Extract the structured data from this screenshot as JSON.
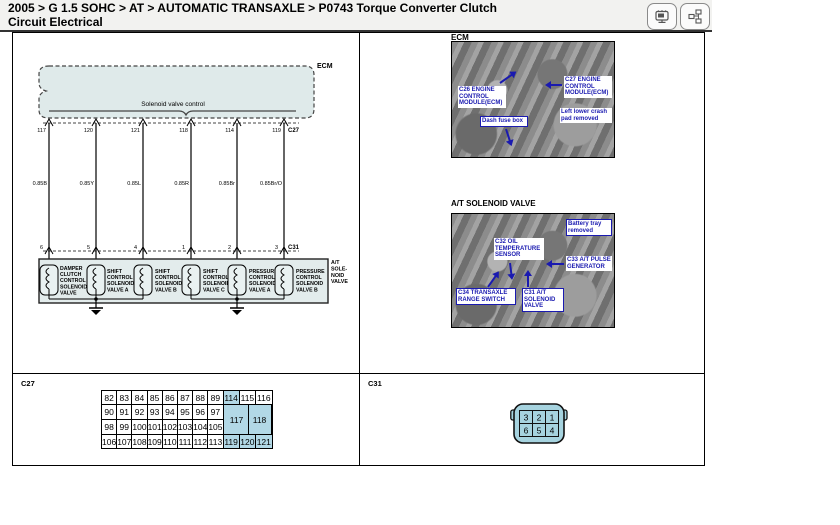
{
  "colors": {
    "callout_blue": "#1a1ab0",
    "highlight_blue": "#b2d8e6",
    "ecm_fill": "#dfeaea",
    "connector_fill": "#a6d3df"
  },
  "header": {
    "title_line1": "2005 > G 1.5 SOHC > AT > AUTOMATIC TRANSAXLE > P0743 Torque Converter Clutch",
    "title_line2": "Circuit Electrical",
    "icons": [
      "window-icon",
      "flowchart-icon"
    ]
  },
  "diagram": {
    "ecm_label": "ECM",
    "bracket_label": "Solenoid valve control",
    "top_connector": "C27",
    "bottom_connector": "C31",
    "wires": [
      {
        "top_pin": "117",
        "wire": "0.85B",
        "bottom_pin": "6"
      },
      {
        "top_pin": "120",
        "wire": "0.85Y",
        "bottom_pin": "5"
      },
      {
        "top_pin": "121",
        "wire": "0.85L",
        "bottom_pin": "4"
      },
      {
        "top_pin": "118",
        "wire": "0.85R",
        "bottom_pin": "1"
      },
      {
        "top_pin": "114",
        "wire": "0.85Br",
        "bottom_pin": "2"
      },
      {
        "top_pin": "119",
        "wire": "0.85Br/O",
        "bottom_pin": "3"
      }
    ],
    "solenoid_box_label": [
      "A/T",
      "SOLE-",
      "NOID",
      "VALVE"
    ],
    "solenoids": [
      [
        "DAMPER",
        "CLUTCH",
        "CONTROL",
        "SOLENOID",
        "VALVE"
      ],
      [
        "SHIFT",
        "CONTROL",
        "SOLENOID",
        "VALVE A"
      ],
      [
        "SHIFT",
        "CONTROL",
        "SOLENOID",
        "VALVE B"
      ],
      [
        "SHIFT",
        "CONTROL",
        "SOLENOID",
        "VALVE C"
      ],
      [
        "PRESSURE",
        "CONTROL",
        "SOLENOID",
        "VALVE A"
      ],
      [
        "PRESSURE",
        "CONTROL",
        "SOLENOID",
        "VALVE B"
      ]
    ]
  },
  "photos": [
    {
      "heading": "ECM",
      "callouts": [
        {
          "text": "C26 ENGINE CONTROL MODULE(ECM)"
        },
        {
          "text": "C27 ENGINE CONTROL MODULE(ECM)"
        },
        {
          "text": "Dash fuse box"
        },
        {
          "text": "Left lower crash pad removed"
        }
      ]
    },
    {
      "heading": "A/T SOLENOID VALVE",
      "callouts": [
        {
          "text": "Battery tray removed"
        },
        {
          "text": "C32 OIL TEMPERATURE SENSOR"
        },
        {
          "text": "C33 A/T PULSE GENERATOR"
        },
        {
          "text": "C34 TRANSAXLE RANGE SWITCH"
        },
        {
          "text": "C31 A/T SOLENOID VALVE"
        }
      ]
    }
  ],
  "c27_panel": {
    "label": "C27",
    "rows": [
      [
        "82",
        "83",
        "84",
        "85",
        "86",
        "87",
        "88",
        "89",
        "114",
        "115",
        "116"
      ],
      [
        "90",
        "91",
        "92",
        "93",
        "94",
        "95",
        "96",
        "97"
      ],
      [
        "98",
        "99",
        "100",
        "101",
        "102",
        "103",
        "104",
        "105"
      ],
      [
        "106",
        "107",
        "108",
        "109",
        "110",
        "111",
        "112",
        "113",
        "119",
        "120",
        "121"
      ]
    ],
    "merged": [
      "117",
      "118"
    ],
    "highlight": [
      "114",
      "117",
      "118",
      "119",
      "120",
      "121"
    ]
  },
  "c31_panel": {
    "label": "C31",
    "pins": [
      "3",
      "2",
      "1",
      "6",
      "5",
      "4"
    ]
  }
}
